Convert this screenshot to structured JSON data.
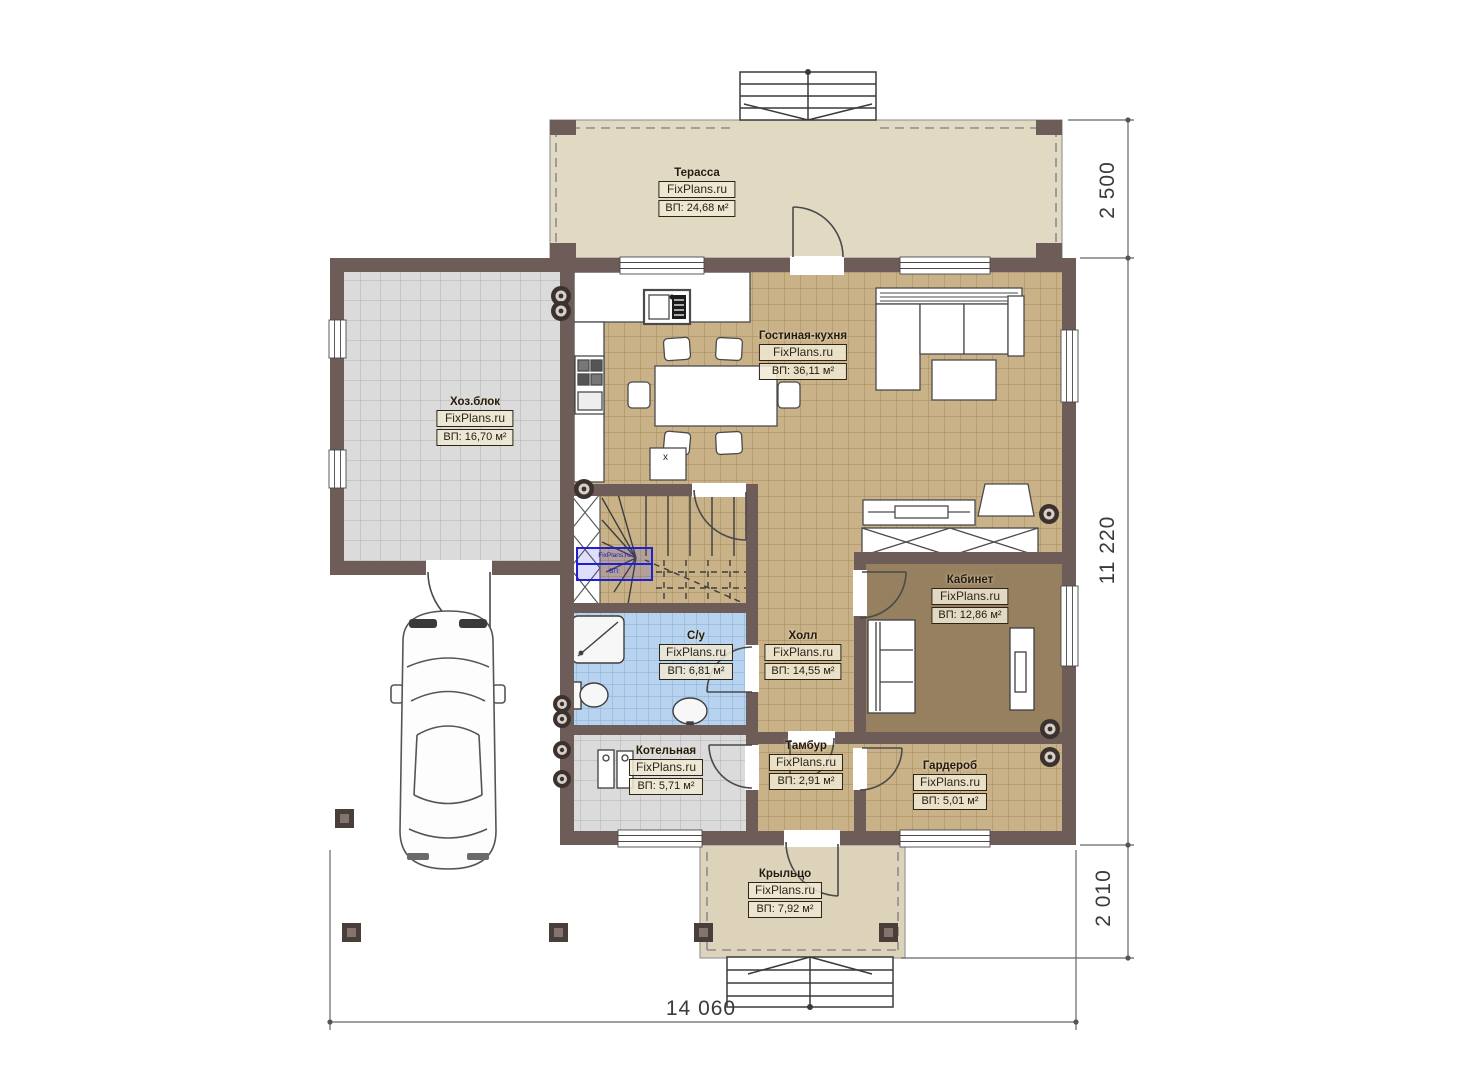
{
  "watermark": "FixPlans.ru",
  "rooms": [
    {
      "id": "terrace",
      "name": "Терасса",
      "area": "ВП: 24,68 м²"
    },
    {
      "id": "living",
      "name": "Гостиная-кухня",
      "area": "ВП: 36,11 м²"
    },
    {
      "id": "hozblok",
      "name": "Хоз.блок",
      "area": "ВП: 16,70 м²"
    },
    {
      "id": "kabinet",
      "name": "Кабинет",
      "area": "ВП: 12,86 м²"
    },
    {
      "id": "su",
      "name": "С/у",
      "area": "ВП: 6,81 м²"
    },
    {
      "id": "hall",
      "name": "Холл",
      "area": "ВП: 14,55 м²"
    },
    {
      "id": "kotelnaya",
      "name": "Котельная",
      "area": "ВП: 5,71 м²"
    },
    {
      "id": "tambur",
      "name": "Тамбур",
      "area": "ВП: 2,91 м²"
    },
    {
      "id": "garderob",
      "name": "Гардероб",
      "area": "ВП: 5,01 м²"
    },
    {
      "id": "kryltso",
      "name": "Крыльцо",
      "area": "ВП: 7,92 м²"
    }
  ],
  "dimensions": {
    "terrace_depth": "2 500",
    "house_depth": "11 220",
    "porch_depth": "2 010",
    "house_width": "14 060"
  },
  "markers": {
    "table_mark": "x"
  },
  "selection": {
    "line1": "FixPlans.ru",
    "line2": "ВП:"
  },
  "colors": {
    "wall": "#6d5c57",
    "floor_tan": "#c9b288",
    "floor_gray": "#dbdbdb",
    "floor_blue": "#b7d3ef",
    "floor_study": "#96805f",
    "terrace": "#e2d9c3",
    "porch": "#ddd2ba",
    "selection_blue": "#2020cc",
    "dimension_line": "#666666"
  }
}
